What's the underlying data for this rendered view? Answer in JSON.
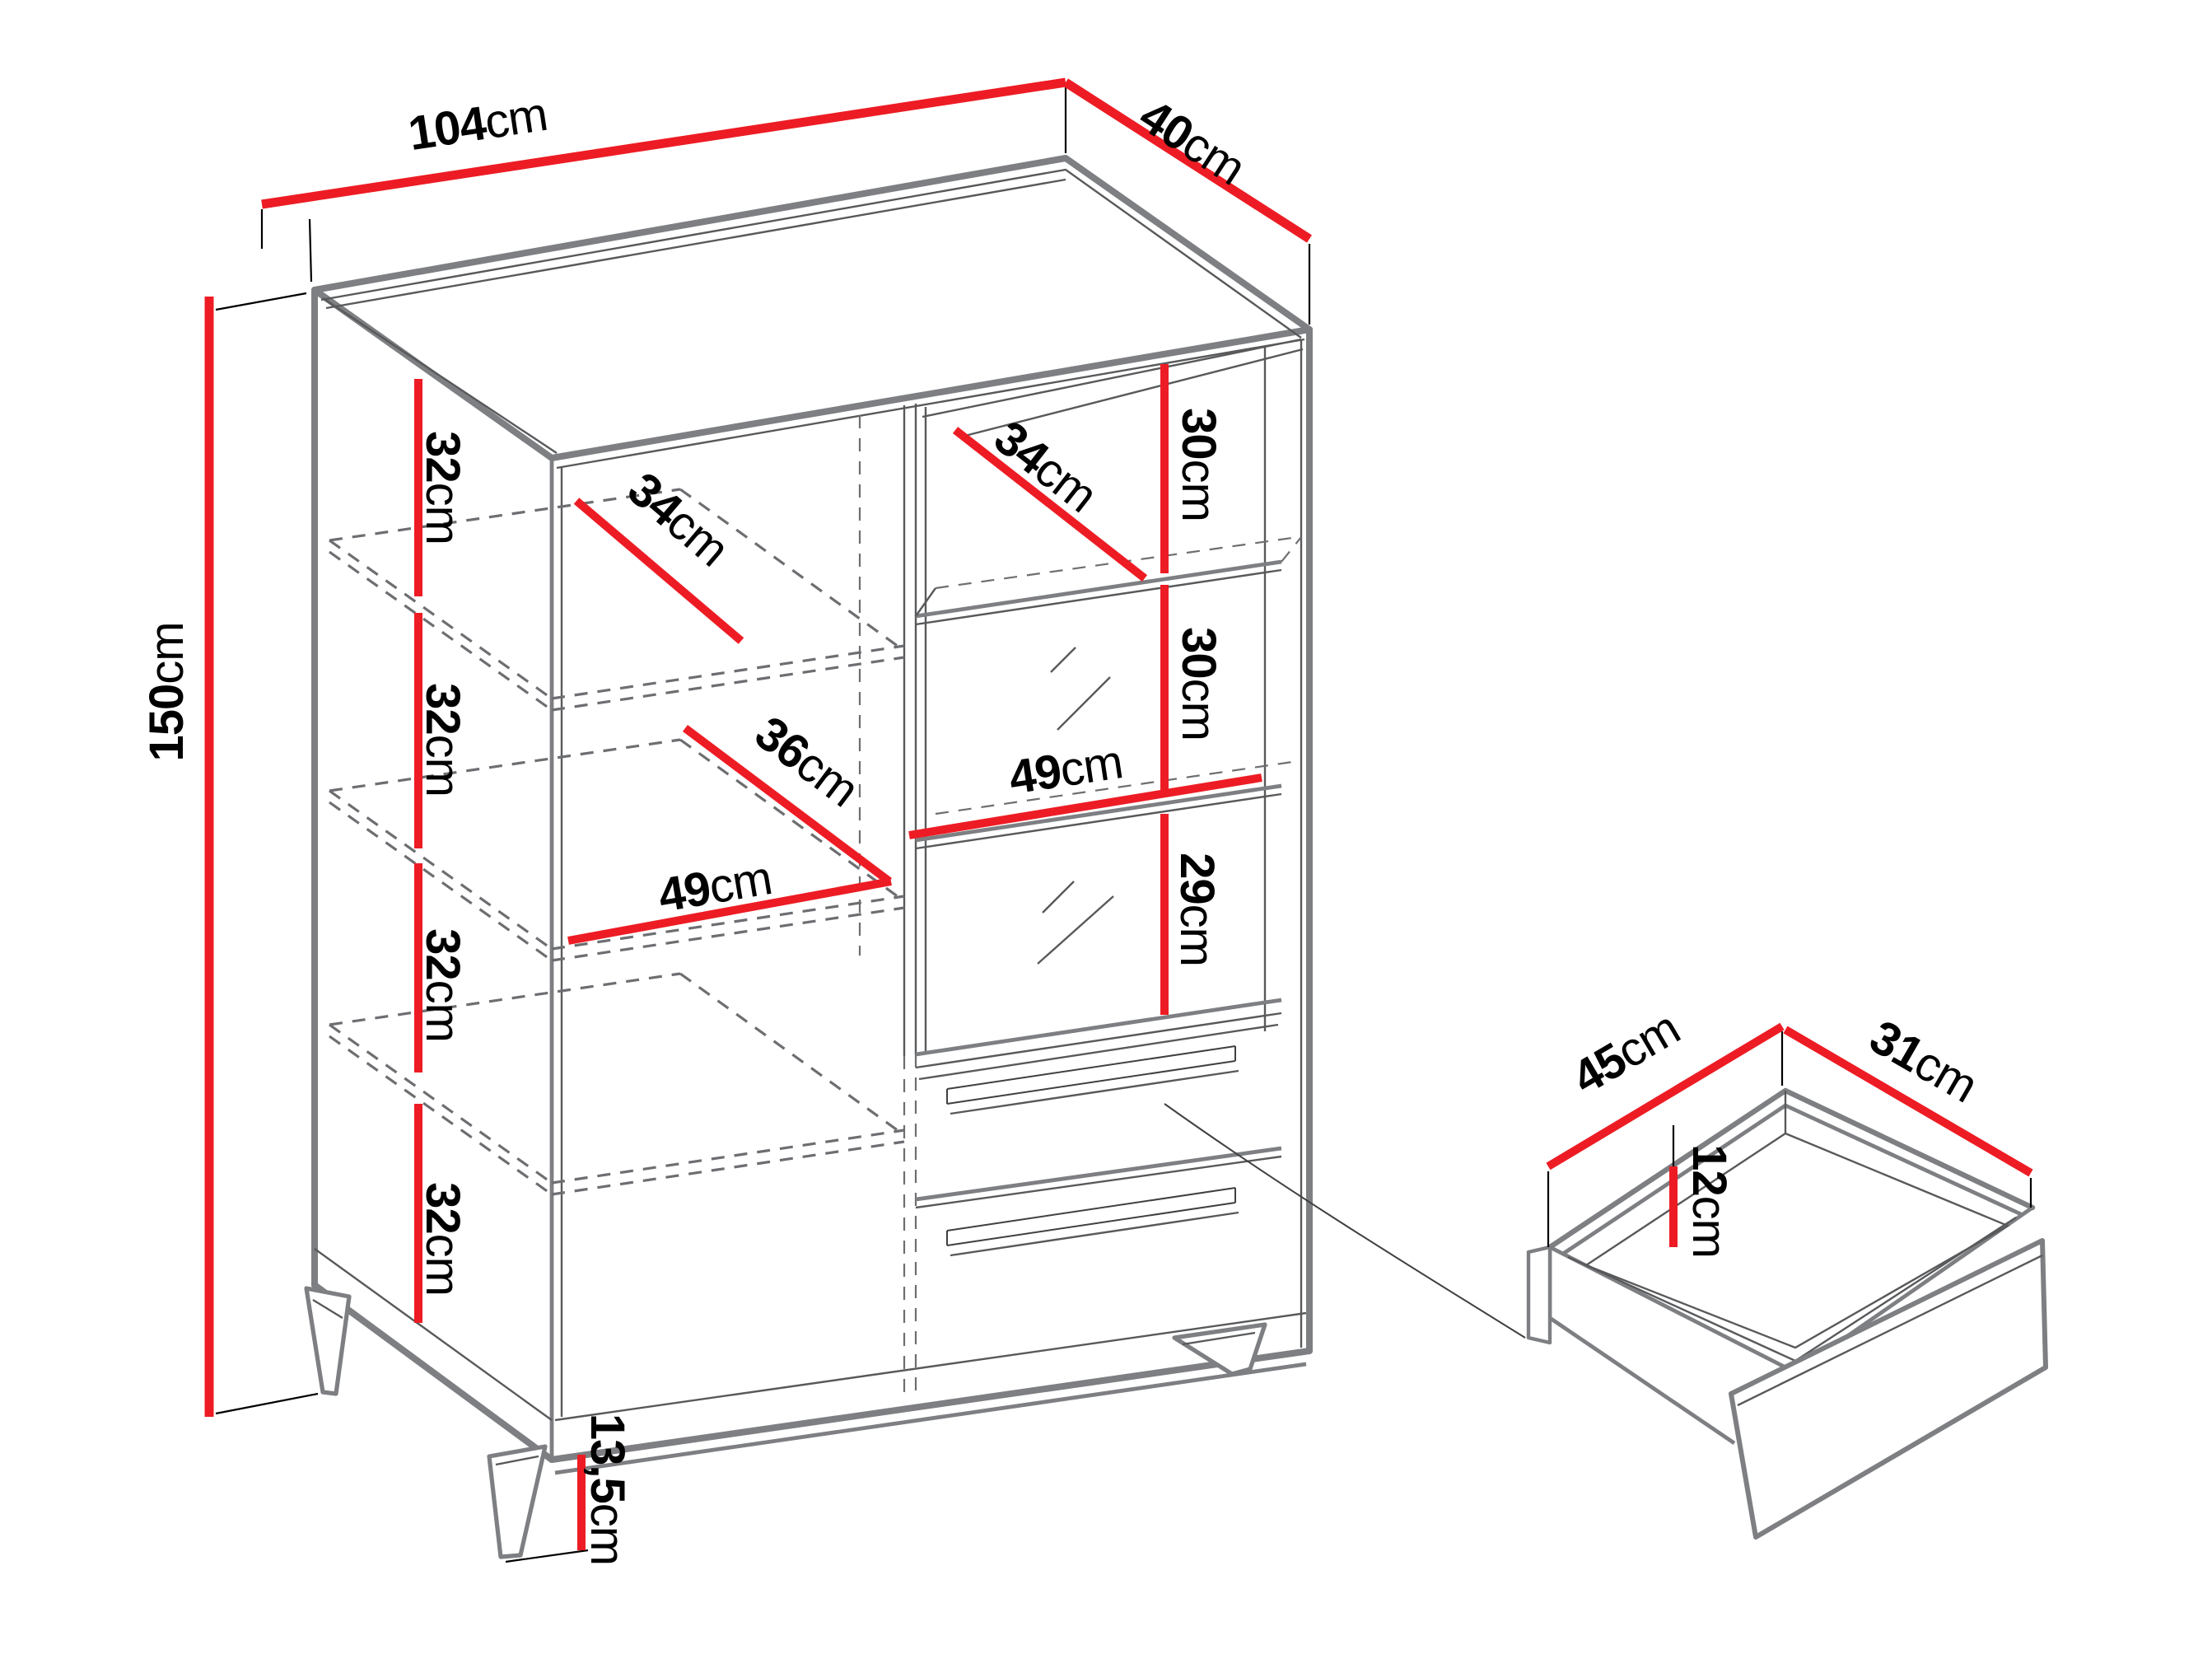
{
  "figure": {
    "type": "furniture-dimension-diagram",
    "subject": "display cabinet with shelves, glass section, drawers and tapered legs",
    "detail_view": "open drawer box"
  },
  "colors": {
    "dimension_line": "#ed1c24",
    "outline_gray": "#7d7f82",
    "outline_dark": "#58595b",
    "text": "#000000",
    "background": "#ffffff"
  },
  "dims": {
    "top_width": {
      "value": "104",
      "unit": "cm"
    },
    "top_depth": {
      "value": "40",
      "unit": "cm"
    },
    "height": {
      "value": "150",
      "unit": "cm"
    },
    "shelf_gap_1": {
      "value": "32",
      "unit": "cm"
    },
    "shelf_gap_2": {
      "value": "32",
      "unit": "cm"
    },
    "shelf_gap_3": {
      "value": "32",
      "unit": "cm"
    },
    "shelf_gap_4": {
      "value": "32",
      "unit": "cm"
    },
    "left_shelf_depth": {
      "value": "34",
      "unit": "cm"
    },
    "left_mid_shelf_depth": {
      "value": "36",
      "unit": "cm"
    },
    "left_inner_width": {
      "value": "49",
      "unit": "cm"
    },
    "right_shelf_depth": {
      "value": "34",
      "unit": "cm"
    },
    "right_gap_1": {
      "value": "30",
      "unit": "cm"
    },
    "right_gap_2": {
      "value": "30",
      "unit": "cm"
    },
    "right_gap_3": {
      "value": "29",
      "unit": "cm"
    },
    "right_inner_width": {
      "value": "49",
      "unit": "cm"
    },
    "leg_height": {
      "value": "13,5",
      "unit": "cm"
    },
    "drawer_depth": {
      "value": "45",
      "unit": "cm"
    },
    "drawer_width": {
      "value": "31",
      "unit": "cm"
    },
    "drawer_inner_height": {
      "value": "12",
      "unit": "cm"
    }
  }
}
